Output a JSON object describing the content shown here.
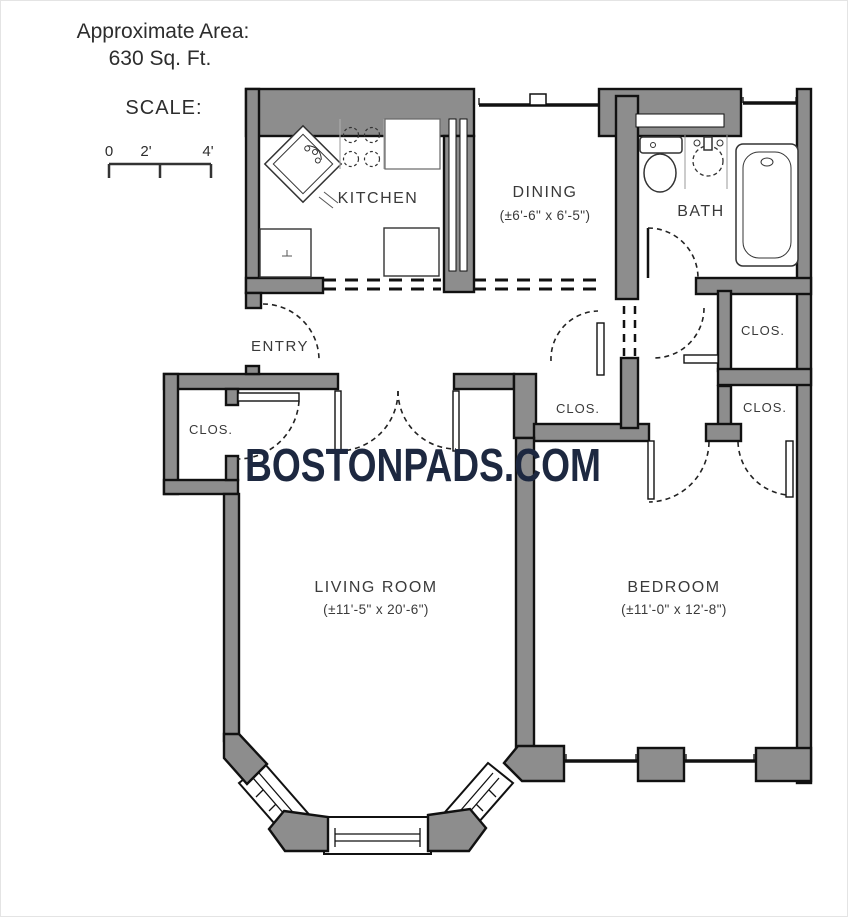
{
  "header": {
    "area_label": "Approximate Area:",
    "area_value": "630 Sq. Ft.",
    "scale_label": "SCALE:",
    "scale_ticks": [
      "0",
      "2'",
      "4'"
    ]
  },
  "watermark": {
    "text": "BOSTONPADS.COM"
  },
  "rooms": {
    "kitchen": {
      "label": "KITCHEN"
    },
    "dining": {
      "label": "DINING",
      "dims": "(±6'-6\" x 6'-5\")"
    },
    "bath": {
      "label": "BATH"
    },
    "entry": {
      "label": "ENTRY"
    },
    "living": {
      "label": "LIVING ROOM",
      "dims": "(±11'-5\" x 20'-6\")"
    },
    "bedroom": {
      "label": "BEDROOM",
      "dims": "(±11'-0\" x 12'-8\")"
    },
    "closets": [
      "CLOS.",
      "CLOS.",
      "CLOS.",
      "CLOS."
    ]
  },
  "colors": {
    "wall": "#8d8d8d",
    "outline": "#111111",
    "watermark_navy": "#1d2840",
    "label_gray": "#3a3a3a",
    "header_gray": "#2d2d2d"
  }
}
